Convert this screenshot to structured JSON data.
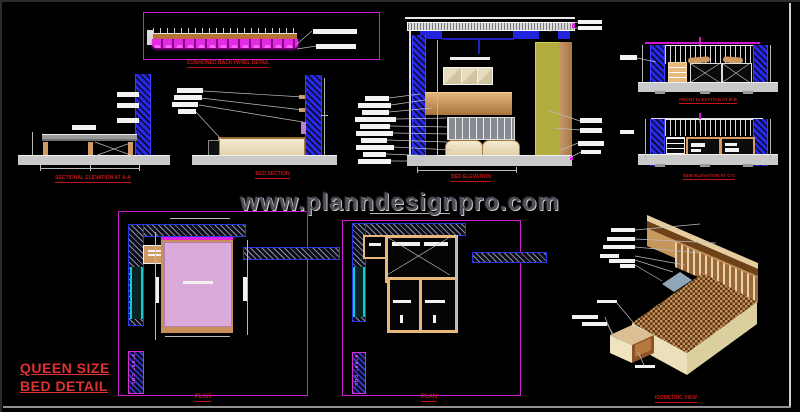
{
  "watermark": "www.planndesignpro.com",
  "title": {
    "line1": "QUEEN SIZE",
    "line2": "BED DETAIL"
  },
  "labels": {
    "cushion_detail": "CUSHIONED BACK PANEL DETAIL",
    "sectional_elevation_aa": "SECTIONAL ELEVATION AT A-A",
    "bed_section": "BED SECTION",
    "bed_elevation": "BED ELEVATION",
    "front_elevation_bb": "FRONT ELEVATION AT B-B",
    "side_elevation_cc": "SIDE ELEVATION AT C-C",
    "plan_left": "PLAN",
    "plan_right": "PLAN",
    "isometric": "ISOMETRIC VIEW",
    "column_left": "9\"X9\" COL.",
    "column_right": "9\"X9\" COL."
  },
  "colors": {
    "background": "#000000",
    "cad_blue": "#2828e8",
    "magenta": "#d516d5",
    "label_red": "#c41414",
    "title_red": "#e03030",
    "tan": "#cf9a62",
    "cream": "#efe3c4",
    "olive": "#b2ac3e",
    "floor_gray": "#c9c9c9",
    "mattress_pink": "#d9aada",
    "watermark_gray": "#50505a"
  }
}
